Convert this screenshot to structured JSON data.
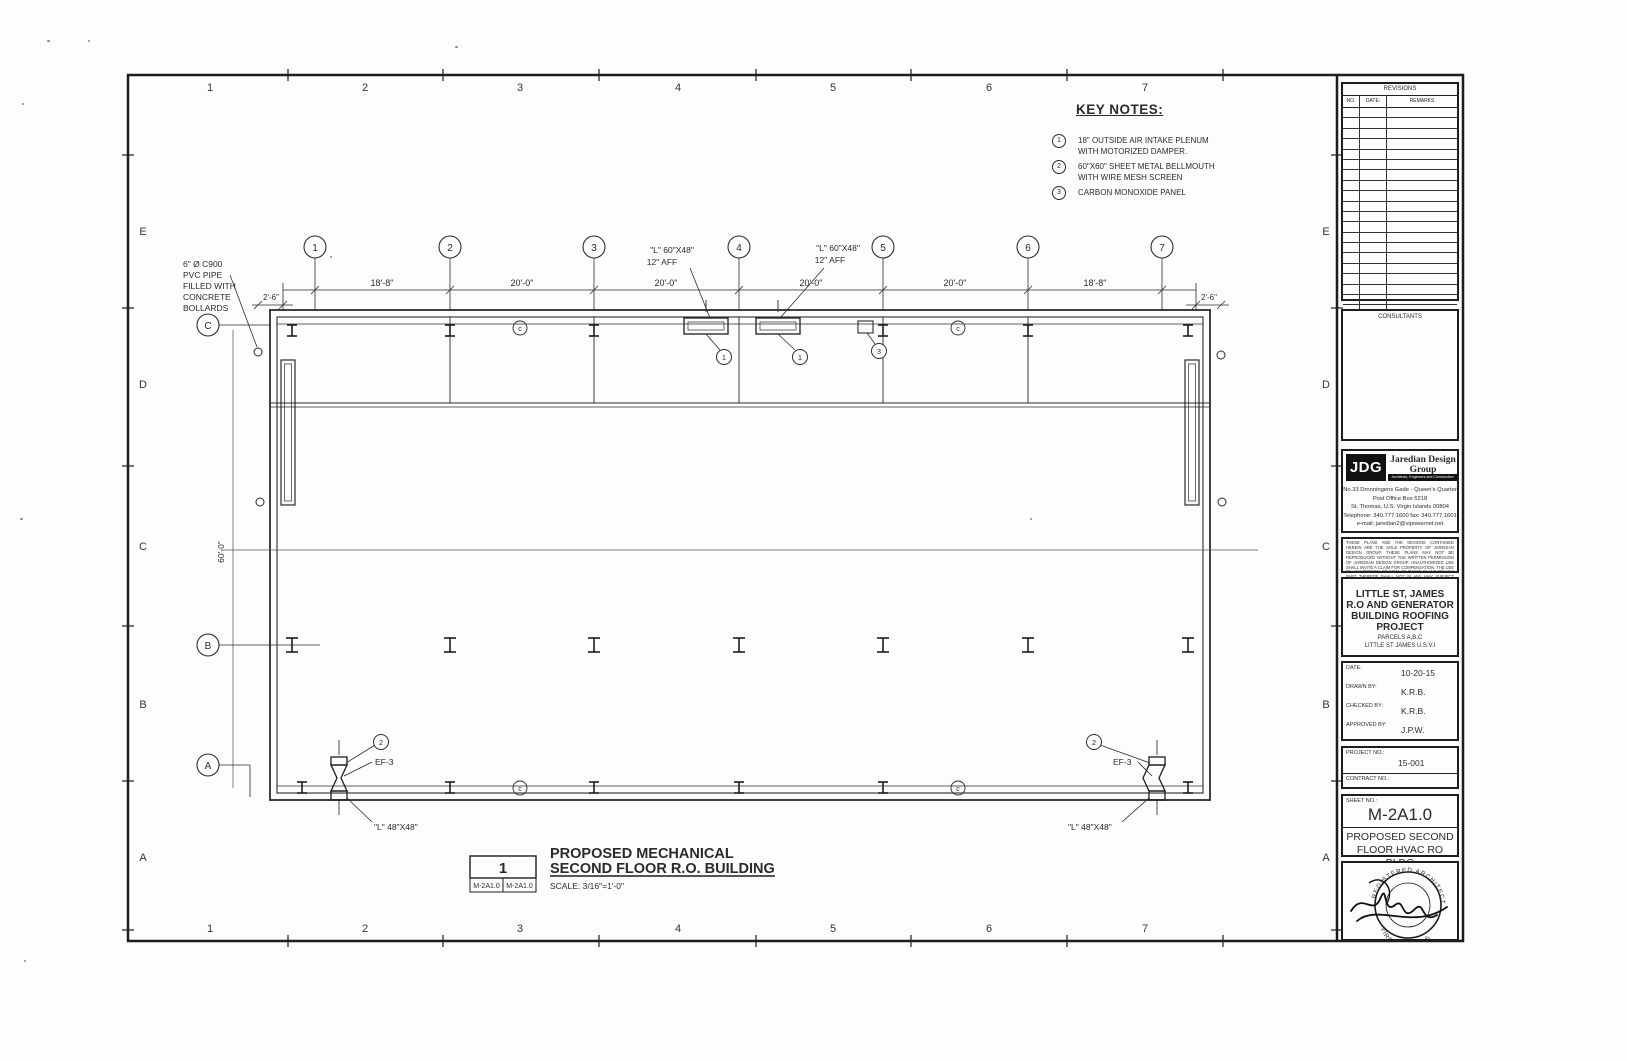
{
  "margin_grid": {
    "cols": [
      "1",
      "2",
      "3",
      "4",
      "5",
      "6",
      "7"
    ],
    "rows": [
      "E",
      "D",
      "C",
      "B",
      "A"
    ]
  },
  "key_notes": {
    "title": "KEY NOTES:",
    "items": [
      {
        "num": "1",
        "line1": "18\" OUTSIDE AIR INTAKE PLENUM",
        "line2": "WITH MOTORIZED DAMPER."
      },
      {
        "num": "2",
        "line1": "60\"X60\" SHEET METAL BELLMOUTH",
        "line2": "WITH WIRE MESH SCREEN"
      },
      {
        "num": "3",
        "line1": "CARBON MONOXIDE PANEL",
        "line2": ""
      }
    ]
  },
  "plan": {
    "bubbles_top": [
      "1",
      "2",
      "3",
      "4",
      "5",
      "6",
      "7"
    ],
    "bubble_c": "C",
    "bubble_b": "B",
    "bubble_a": "A",
    "dims_top": [
      "18'-8\"",
      "20'-0\"",
      "20'-0\"",
      "20'-0\"",
      "20'-0\"",
      "18'-8\""
    ],
    "dim_left": "2'-6\"",
    "dim_right": "2'-6\"",
    "dim_vert": "60'-0\"",
    "bollard_note": [
      "6\" Ø C900",
      "PVC PIPE",
      "FILLED WITH",
      "CONCRETE",
      "BOLLARDS"
    ],
    "louver_top_line1": "\"L\" 60\"X48\"",
    "louver_top_line2": "12\" AFF",
    "louver_bottom": "\"L\" 48\"X48\"",
    "fan_tag": "EF-3",
    "keynote_1": "1",
    "keynote_2": "2",
    "keynote_3": "3",
    "col_mark": "c"
  },
  "drawing_title": {
    "detail_num": "1",
    "ref_left": "M-2A1.0",
    "ref_right": "M-2A1.0",
    "line1": "PROPOSED MECHANICAL",
    "line2": "SECOND FLOOR R.O. BUILDING",
    "scale": "SCALE: 3/16\"=1'-0\""
  },
  "title_block": {
    "revisions": {
      "title": "REVISIONS",
      "no": "NO.",
      "date": "DATE:",
      "remarks": "REMARKS"
    },
    "consultants": "CONSULTANTS",
    "firm": {
      "logo": "JDG",
      "name": "Jaredian Design Group",
      "tagline": "Architects, Engineers and Construction Managers",
      "address1": "No.33 Dronningens Gade - Queen's Quarter",
      "address2": "Post Office Box 6218",
      "address3": "St. Thomas, U.S. Virgin Islands 00804",
      "address4": "Telephone: 340.777.1600 fax: 340.777.1601",
      "address5": "e-mail: jaredian2@vipowernet.net"
    },
    "disclaimer": "THESE PLANS AND THE DESIGNS CONTAINED HEREIN ARE THE SOLE PROPERTY OF JAREDIAN DESIGN GROUP.  THESE PLANS MAY NOT BE REPRODUCED WITHOUT THE WRITTEN PERMISSION OF JAREDIAN DESIGN GROUP. UNAUTHORIZED USE SHALL INVITE A CLAIM FOR COMPENSATION. THE USE BY ANY PERSON OR FIRM OF THESE PLANS OR ANY PART THEREOF SHALL NOT IN ANY WAY SUBJECT JAREDIAN DESIGN GROUP TO ANY COST OR DAMAGES FOR ANY ERROR OR OMISSION CONTAINED THEREIN.",
    "project": [
      "LITTLE ST, JAMES",
      "R.O AND GENERATOR",
      "BUILDING ROOFING",
      "PROJECT",
      "PARCELS A,B,C",
      "LITTLE ST JAMES  U.S.V.I"
    ],
    "fields": [
      {
        "label": "DATE:",
        "value": "10-20-15"
      },
      {
        "label": "DRAWN BY:",
        "value": "K.R.B."
      },
      {
        "label": "CHECKED BY:",
        "value": "K.R.B."
      },
      {
        "label": "APPROVED BY:",
        "value": "J.P.W."
      }
    ],
    "project_no_label": "PROJECT NO.:",
    "project_no": "15-001",
    "contract_no_label": "CONTRACT NO.:",
    "sheet_no_label": "SHEET NO.:",
    "sheet_no": "M-2A1.0",
    "sheet_title": [
      "PROPOSED SECOND",
      "FLOOR  HVAC RO BLDG"
    ],
    "stamp_top": "REGISTERED ARCHITECT",
    "stamp_bottom": "VIRGIN ISLANDS"
  }
}
